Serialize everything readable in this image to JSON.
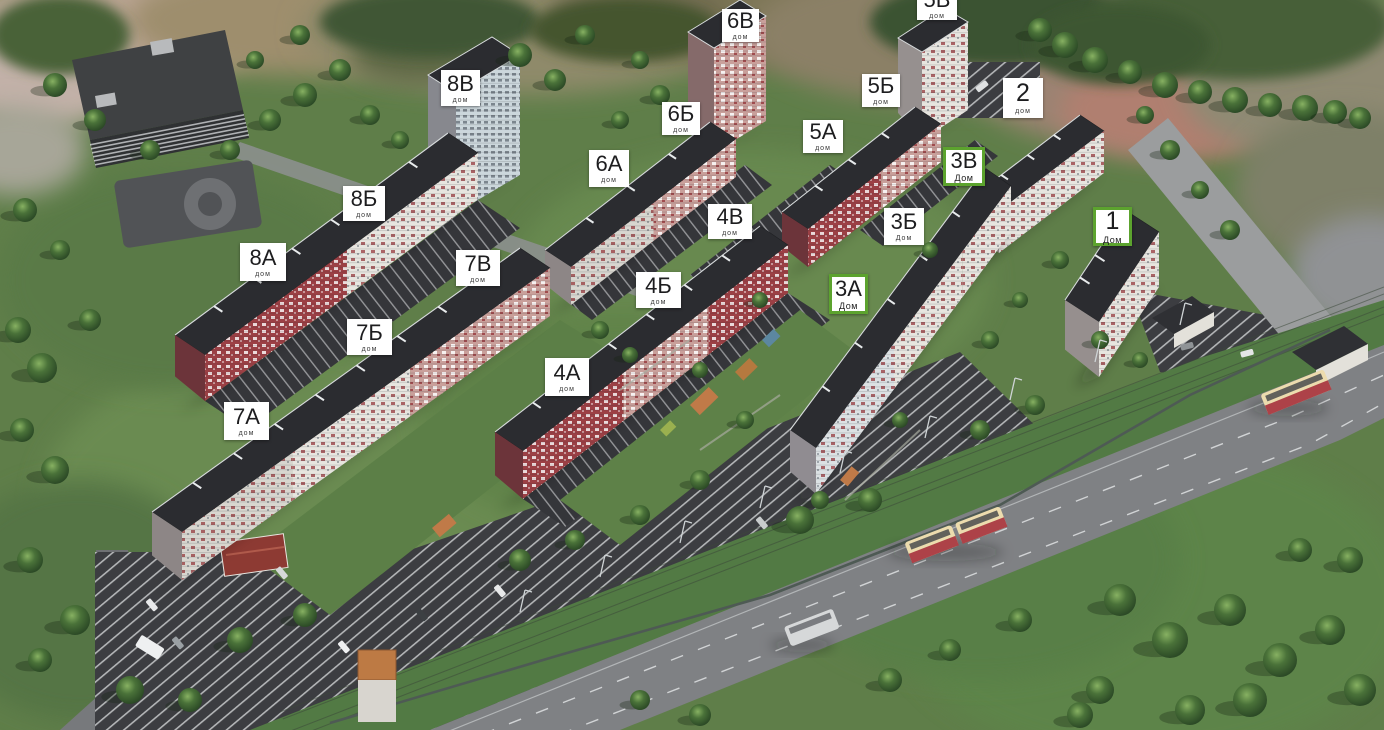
{
  "markers": [
    {
      "id": "5v",
      "label": "5В",
      "sublabel": "дом",
      "x": 917,
      "y": -12,
      "w": 40,
      "h": 32,
      "highlighted": false
    },
    {
      "id": "6v",
      "label": "6В",
      "sublabel": "дом",
      "x": 722,
      "y": 9,
      "w": 37,
      "h": 33,
      "highlighted": false
    },
    {
      "id": "8v",
      "label": "8В",
      "sublabel": "дом",
      "x": 441,
      "y": 70,
      "w": 39,
      "h": 36,
      "highlighted": false
    },
    {
      "id": "5b",
      "label": "5Б",
      "sublabel": "дом",
      "x": 862,
      "y": 74,
      "w": 38,
      "h": 33,
      "highlighted": false
    },
    {
      "id": "2",
      "label": "2",
      "sublabel": "дом",
      "x": 1003,
      "y": 78,
      "w": 40,
      "h": 40,
      "highlighted": false
    },
    {
      "id": "6b",
      "label": "6Б",
      "sublabel": "дом",
      "x": 662,
      "y": 102,
      "w": 38,
      "h": 33,
      "highlighted": false
    },
    {
      "id": "5a",
      "label": "5А",
      "sublabel": "дом",
      "x": 803,
      "y": 120,
      "w": 40,
      "h": 33,
      "highlighted": false
    },
    {
      "id": "3v",
      "label": "3В",
      "sublabel": "Дом",
      "x": 943,
      "y": 147,
      "w": 42,
      "h": 39,
      "highlighted": true
    },
    {
      "id": "6a",
      "label": "6А",
      "sublabel": "дом",
      "x": 589,
      "y": 150,
      "w": 40,
      "h": 37,
      "highlighted": false
    },
    {
      "id": "8b",
      "label": "8Б",
      "sublabel": "дом",
      "x": 343,
      "y": 186,
      "w": 42,
      "h": 35,
      "highlighted": false
    },
    {
      "id": "4v",
      "label": "4В",
      "sublabel": "дом",
      "x": 708,
      "y": 204,
      "w": 44,
      "h": 35,
      "highlighted": false
    },
    {
      "id": "3b",
      "label": "3Б",
      "sublabel": "Дом",
      "x": 884,
      "y": 208,
      "w": 40,
      "h": 37,
      "highlighted": false
    },
    {
      "id": "1",
      "label": "1",
      "sublabel": "Дом",
      "x": 1093,
      "y": 207,
      "w": 39,
      "h": 39,
      "highlighted": true
    },
    {
      "id": "8a",
      "label": "8А",
      "sublabel": "дом",
      "x": 240,
      "y": 243,
      "w": 46,
      "h": 38,
      "highlighted": false
    },
    {
      "id": "7v",
      "label": "7В",
      "sublabel": "дом",
      "x": 456,
      "y": 250,
      "w": 44,
      "h": 36,
      "highlighted": false
    },
    {
      "id": "4b",
      "label": "4Б",
      "sublabel": "дом",
      "x": 636,
      "y": 272,
      "w": 45,
      "h": 36,
      "highlighted": false
    },
    {
      "id": "3a",
      "label": "3А",
      "sublabel": "Дом",
      "x": 829,
      "y": 274,
      "w": 39,
      "h": 40,
      "highlighted": true
    },
    {
      "id": "7b",
      "label": "7Б",
      "sublabel": "дом",
      "x": 347,
      "y": 319,
      "w": 45,
      "h": 36,
      "highlighted": false
    },
    {
      "id": "4a",
      "label": "4А",
      "sublabel": "дом",
      "x": 545,
      "y": 358,
      "w": 44,
      "h": 38,
      "highlighted": false
    },
    {
      "id": "7a",
      "label": "7А",
      "sublabel": "дом",
      "x": 224,
      "y": 402,
      "w": 45,
      "h": 38,
      "highlighted": false
    }
  ],
  "colors": {
    "marker_bg": "#ffffff",
    "marker_text": "#1d1d1f",
    "marker_highlight_border": "#5ca32e",
    "grass": "#5f7e49",
    "asphalt_parking": "#3c3d41",
    "road": "#7f8184",
    "roof": "#2b2c30",
    "facade_red": "#9c4045",
    "facade_white": "#e7e5df",
    "facade_blue": "#ccd7dc",
    "tram_body": "#ecdcae",
    "tram_accent": "#ad4248"
  }
}
